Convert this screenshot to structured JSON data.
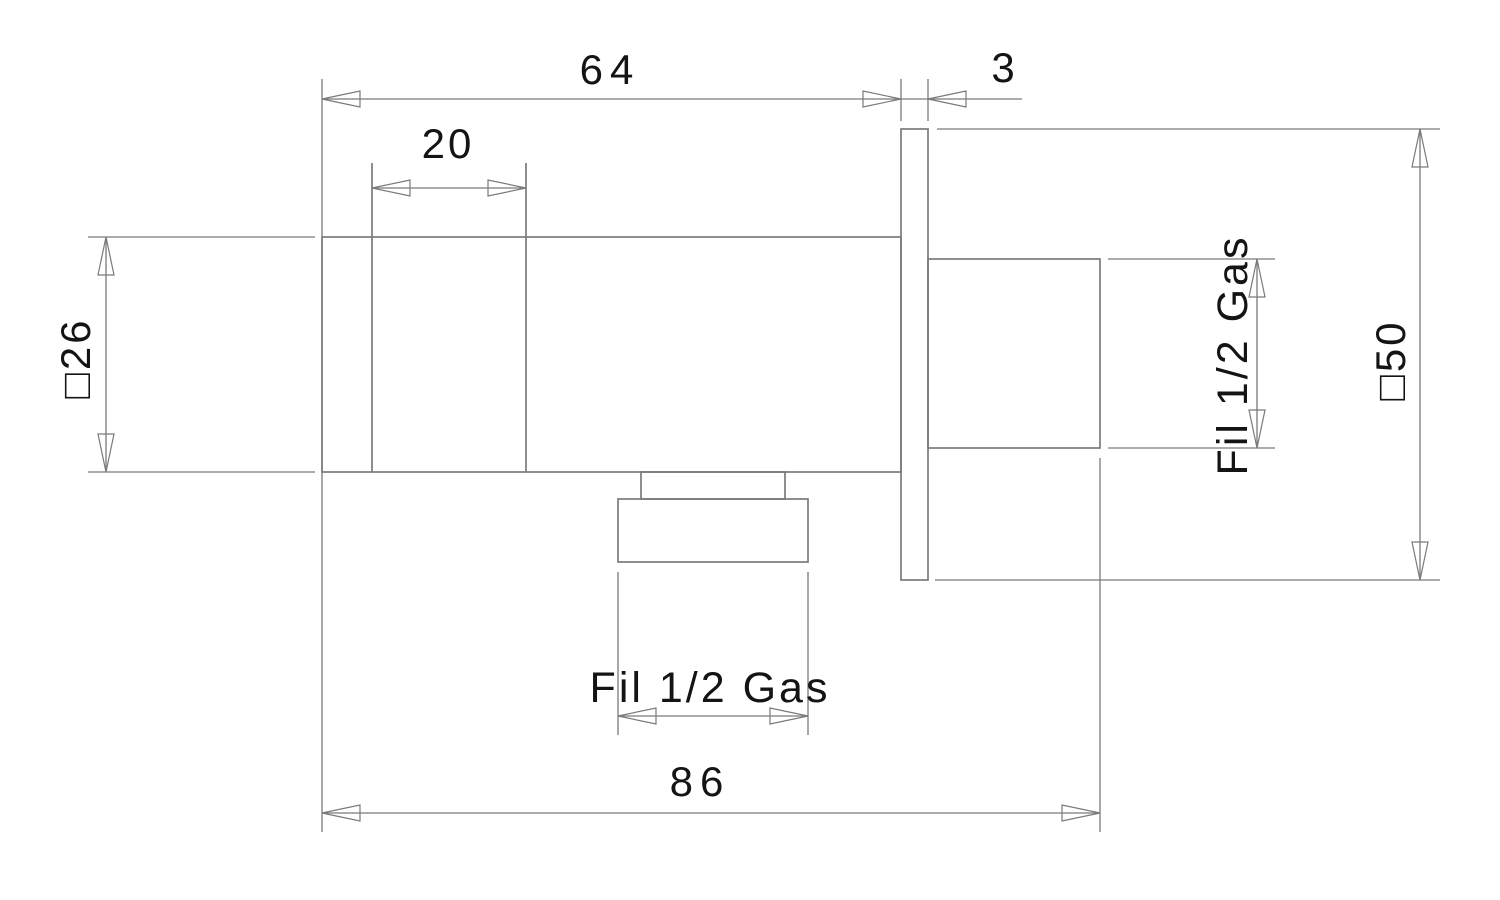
{
  "drawing": {
    "labels": {
      "body_length": "64",
      "plate_thickness": "3",
      "bonnet_width": "20",
      "body_square_section": "□26",
      "plate_square_section": "□50",
      "inlet_thread": "Fil 1/2 Gas",
      "outlet_thread": "Fil 1/2 Gas",
      "overall_length": "86"
    },
    "colors": {
      "line": "#7a7a7a",
      "text": "#141414",
      "background": "#ffffff"
    }
  }
}
